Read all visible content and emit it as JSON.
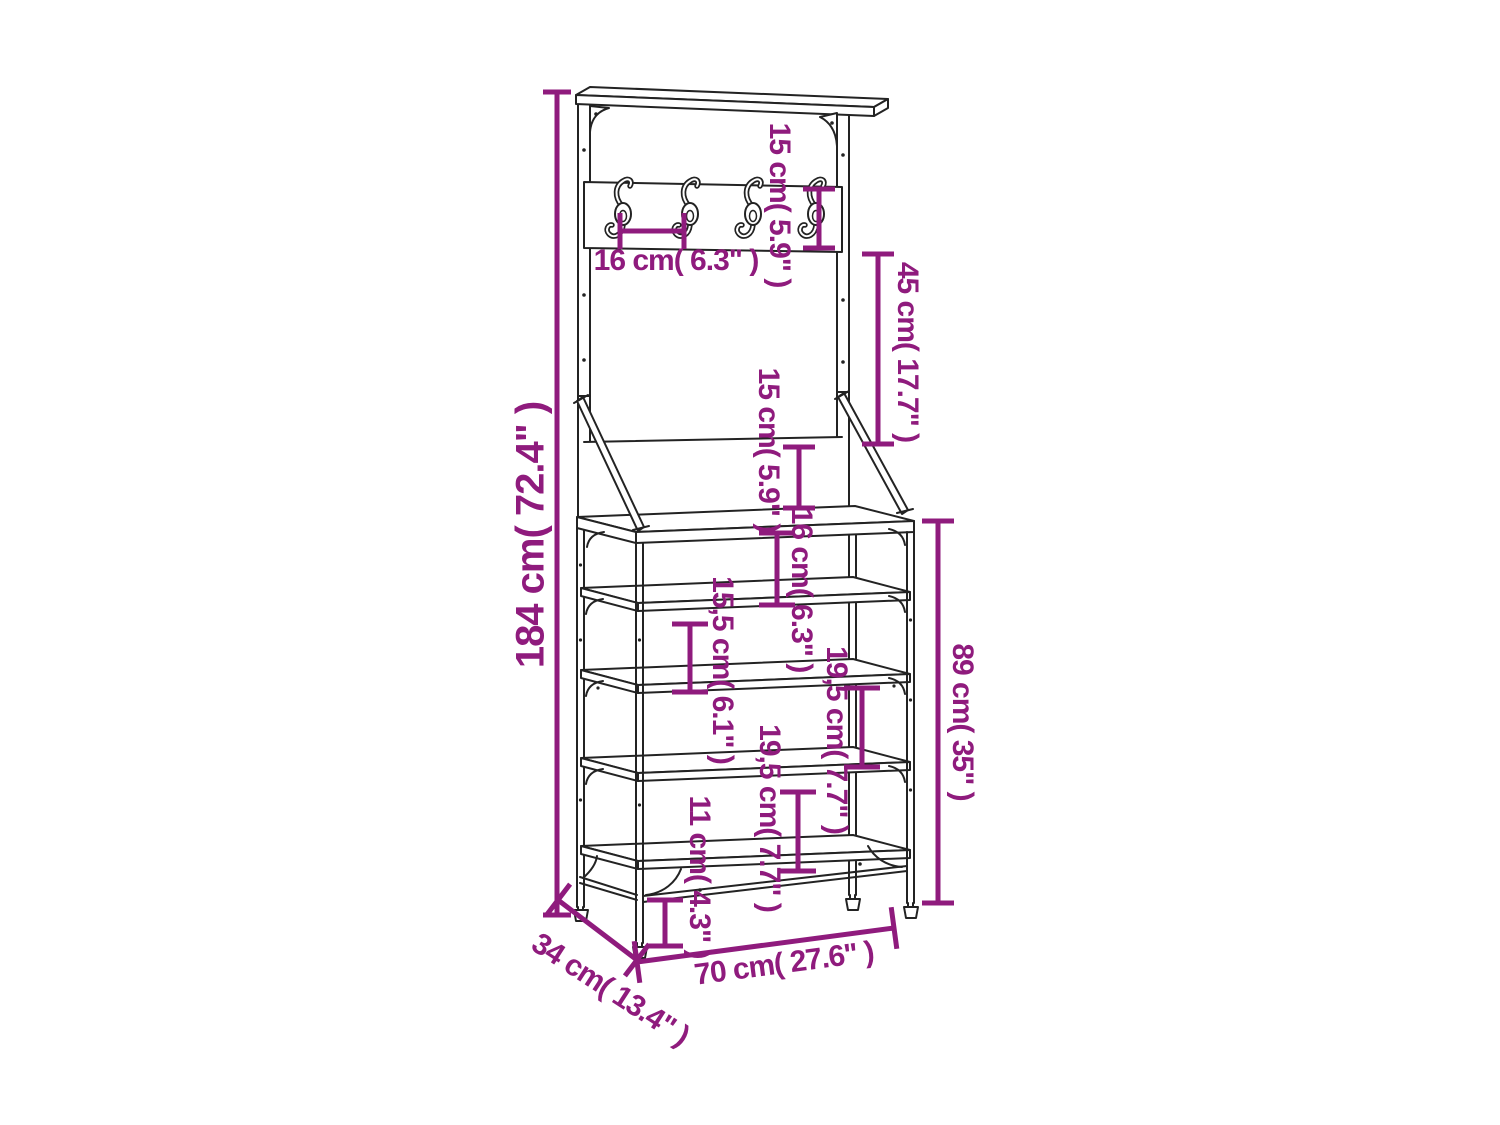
{
  "diagram": {
    "kind": "furniture-dimension-drawing",
    "subject": "coat-rack-with-shoe-shelves",
    "colors": {
      "dimension": "#8F1B7D",
      "line_art": "#232323",
      "background": "#ffffff"
    },
    "dimensions": [
      {
        "id": "total-height",
        "label": "184 cm( 72.4\" )",
        "cm": "184",
        "inch": "72.4"
      },
      {
        "id": "hook-board-height",
        "label": "15 cm( 5.9\" )",
        "cm": "15",
        "inch": "5.9"
      },
      {
        "id": "hook-spacing",
        "label": "16 cm( 6.3\" )",
        "cm": "16",
        "inch": "6.3"
      },
      {
        "id": "frame-gap-height",
        "label": "45 cm( 17.7\" )",
        "cm": "45",
        "inch": "17.7"
      },
      {
        "id": "panel-height",
        "label": "15 cm( 5.9\" )",
        "cm": "15",
        "inch": "5.9"
      },
      {
        "id": "table-to-shelf",
        "label": "16 cm( 6.3\" )",
        "cm": "16",
        "inch": "6.3"
      },
      {
        "id": "shelf-gap-1",
        "label": "15,5 cm( 6.1\" )",
        "cm": "15,5",
        "inch": "6.1"
      },
      {
        "id": "shelf-gap-2",
        "label": "19,5 cm( 7.7\" )",
        "cm": "19,5",
        "inch": "7.7"
      },
      {
        "id": "shelf-gap-3",
        "label": "19,5 cm( 7.7\" )",
        "cm": "19,5",
        "inch": "7.7"
      },
      {
        "id": "foot-height",
        "label": "11 cm( 4.3\" )",
        "cm": "11",
        "inch": "4.3"
      },
      {
        "id": "rack-height",
        "label": "89 cm( 35\" )",
        "cm": "89",
        "inch": "35"
      },
      {
        "id": "width",
        "label": "70 cm( 27.6\" )",
        "cm": "70",
        "inch": "27.6"
      },
      {
        "id": "depth",
        "label": "34 cm( 13.4\" )",
        "cm": "34",
        "inch": "13.4"
      }
    ]
  }
}
